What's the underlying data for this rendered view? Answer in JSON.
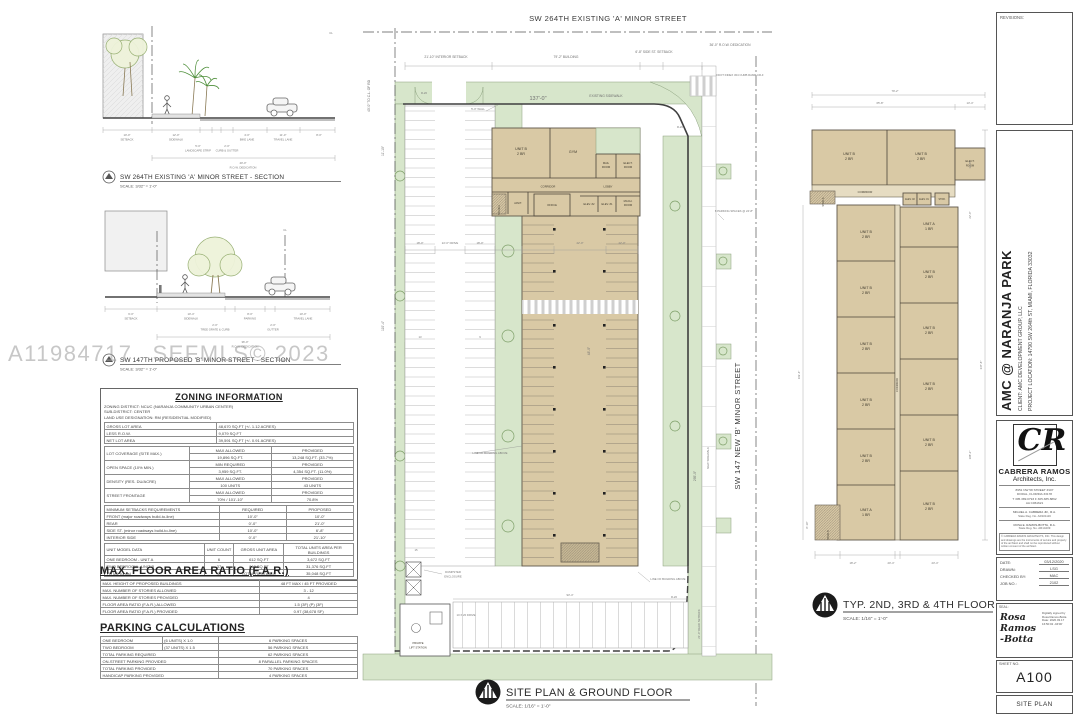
{
  "watermark": {
    "id": "A11984717",
    "mls": "SEFMLS© 2023"
  },
  "section_a": {
    "title": "SW 264TH EXISTING 'A' MINOR STREET - SECTION",
    "scale": "SCALE:  3/32\" = 1'-0\"",
    "dims": [
      {
        "v": "10'-0\"",
        "l": "SETBACK"
      },
      {
        "v": "12'-0\"",
        "l": "SIDEWALK"
      },
      {
        "v": "5'-0\"",
        "l": "LANDSCAPE STRIP"
      },
      {
        "v": "2'-0\"",
        "l": "CURB & GUTTER"
      },
      {
        "v": "4'-0\"",
        "l": "BIKE LANE"
      },
      {
        "v": "11'-0\"",
        "l": "TRAVEL LANE"
      },
      {
        "v": "8'-0\"",
        "l": ""
      }
    ],
    "row": {
      "v": "40'-0\"",
      "l": "R.O.W. DEDICATION"
    },
    "cl": "CL"
  },
  "section_b": {
    "title": "SW 147TH PROPOSED 'B' MINOR STREET - SECTION",
    "scale": "SCALE:  3/32\" = 1'-0\"",
    "dims": [
      {
        "v": "6'-0\"",
        "l": "SETBACK"
      },
      {
        "v": "10'-4\"",
        "l": "SIDEWALK"
      },
      {
        "v": "2'-0\"",
        "l": "TREE GRATE & CURB"
      },
      {
        "v": "8'-0\"",
        "l": "PARKING"
      },
      {
        "v": "2'-0\"",
        "l": "GUTTER"
      },
      {
        "v": "10'-0\"",
        "l": "TRAVEL LANE"
      }
    ],
    "row": {
      "v": "36'-0\"",
      "l": "R.O.W. DEDICATION"
    },
    "cl": "CL"
  },
  "zoning": {
    "title": "ZONING INFORMATION",
    "district": "ZONING DISTRICT: NCUC (NARANJA COMMUNITY URBAN CENTER)",
    "sub": "SUB-DISTRICT: CENTER",
    "landuse": "LAND USE DESIGNATION: RM (RESIDENTIAL MODIFIED)",
    "areas": [
      {
        "label": "GROSS LOT AREA",
        "value": "48,670 SQ.FT (+/- 1.12 ACRES)"
      },
      {
        "label": "LESS R.O.W.",
        "value": "9,079 SQ.FT"
      },
      {
        "label": "NET LOT AREA",
        "value": "39,591 SQ.FT (+/- 0.91 ACRES)"
      }
    ],
    "matrix": [
      {
        "label": "LOT COVERAGE (SITE MAX.)",
        "h1": "MAX ALLOWED",
        "h2": "PROVIDED",
        "v1": "19,896 SQ.FT.",
        "v2": "13,248 SQ.FT. (33.7%)"
      },
      {
        "label": "OPEN SPACE (10% MIN.)",
        "h1": "MIN REQUIRED",
        "h2": "PROVIDED",
        "v1": "3,959 SQ.FT.",
        "v2": "4,354 SQ.FT. (11.0%)"
      },
      {
        "label": "DENSITY (RES. DU/ACRE)",
        "h1": "MAX ALLOWED",
        "h2": "PROVIDED",
        "v1": "100 UNITS",
        "v2": "43 UNITS"
      },
      {
        "label": "STREET FRONTAGE",
        "h1": "MAX ALLOWED",
        "h2": "PROVIDED",
        "v1": "70% / 101'-10\"",
        "v2": "70.8%"
      }
    ],
    "setbacks": {
      "title": "MINIMUM SETBACKS REQUIREMENTS",
      "h1": "REQUIRED",
      "h2": "PROPOSED",
      "rows": [
        {
          "label": "FRONT (major roadways build-to-line)",
          "r": "10'-0\"",
          "p": "10'-0\""
        },
        {
          "label": "REAR",
          "r": "0'-0\"",
          "p": "21'-0\""
        },
        {
          "label": "SIDE ST. (minor roadways build-to-line)",
          "r": "10'-0\"",
          "p": "6'-8\""
        },
        {
          "label": "INTERIOR SIDE",
          "r": "0'-0\"",
          "p": "21'-10\""
        }
      ]
    },
    "units": {
      "h0": "UNIT MODEL DATA",
      "h1": "UNIT COUNT",
      "h2": "GROSS UNIT AREA",
      "h3": "TOTAL UNITS AREA PER BUILDINGS",
      "rows": [
        {
          "label": "ONE BEDROOM  -  UNIT A",
          "c": "6",
          "a": "612 SQ.FT",
          "t": "3,672 SQ.FT"
        },
        {
          "label": "TWO BEDROOM  -  UNIT B",
          "c": "37",
          "a": "848 SQ.FT",
          "t": "31,376 SQ.FT"
        }
      ],
      "trow": {
        "label": "TOTAL (units)",
        "c": "43",
        "a": "TOTAL RENTABLE",
        "t": "35,048 SQ.FT"
      }
    }
  },
  "far": {
    "title": "MAX. FLOOR AREA RATIO (F.A.R.)",
    "rows": [
      {
        "label": "MAX. HEIGHT OF PROPOSED BUILDINGS",
        "value": "48 FT MAX / 45 FT PROVIDED"
      },
      {
        "label": "MAX. NUMBER OF STORIES ALLOWED",
        "value": "3 - 12"
      },
      {
        "label": "MAX. NUMBER OF STORIES PROVIDED",
        "value": "4"
      },
      {
        "label": "FLOOR AREA RATIO (F.A.R.) ALLOWED",
        "value": "1.5 (3F) (P) (3F)"
      },
      {
        "label": "FLOOR AREA RATIO (F.A.R.) PROVIDED",
        "value": "0.97 (38,678 SF)"
      }
    ]
  },
  "parking_calc": {
    "title": "PARKING CALCULATIONS",
    "rows": [
      {
        "label": "ONE BEDROOM",
        "calc": "(6 UNITS) X 1.0",
        "value": "6 PARKING SPACES"
      },
      {
        "label": "TWO BEDROOM",
        "calc": "(37 UNITS) X 1.5",
        "value": "56 PARKING SPACES"
      }
    ],
    "totals": [
      {
        "label": "TOTAL PARKING REQUIRED",
        "value": "62 PARKING SPACES"
      },
      {
        "label": "ON-STREET PARKING PROVIDED",
        "value": "8 PARALLEL PARKING SPACES"
      },
      {
        "label": "TOTAL PARKING PROVIDED",
        "value": "70 PARKING SPACES"
      },
      {
        "label": "HANDICAP PARKING PROVIDED",
        "value": "4 PARKING SPACES"
      }
    ]
  },
  "site": {
    "street_top": "SW 264TH EXISTING 'A' MINOR STREET",
    "street_right": "SW 147 NEW 'B' MINOR STREET",
    "title": "SITE PLAN & GROUND FLOOR",
    "scale": "SCALE:   1/16\" = 1'-0\"",
    "dims": {
      "interior_setback": "21'-10\" INTERIOR SETBACK",
      "building": "79'-2\"  BUILDING",
      "side_setback": "6'-8\" SIDE ST. SETBACK",
      "row_ded": "36'-0\" R.O.W. DEDICATION",
      "d137": "137'-0\"",
      "d295": "295'-0\"",
      "d110": "110'-4\"",
      "d1110": "11'-10\"",
      "d48": "48'-0\"",
      "d18a": "18'-0\"",
      "drive": "22'-0\" DRIVE",
      "d18b": "18'-0\"",
      "d22a": "22'-0\"",
      "d22b": "22'-0\"",
      "d934": "93'-4\"",
      "rear": "21'-0\" REAR SETBACK",
      "to_cl": "40'-0\" TO C.L. OF RD"
    },
    "notes": {
      "existing_sidewalk": "EXISTING SIDEWALK",
      "new_sidewalk": "NEW SIDEWALK",
      "wall": "5'-0\" WALL",
      "fdot": "FDOT INDEX 304 CURB RAMP CR-F",
      "parking8": "8 PARKING SPACES @ 24'-8\"",
      "dumpster1": "DUMPSTER",
      "dumpster2": "ENCLOSURE",
      "lift1": "PRIVATE",
      "lift2": "LIFT STATION",
      "drive1020": "10 X 20 DRIVE",
      "line_above1": "LINE OF BUILDING ABOVE",
      "line_above2": "LINE OF BUILDING ABOVE",
      "r20": "R-20",
      "s13": "13",
      "s9": "9",
      "s15": "15"
    },
    "rooms": {
      "unit_b": "UNIT B",
      "br2": "2 BR",
      "gym": "GYM",
      "mail1": "MAIL",
      "mail2": "ROOM",
      "elect1": "ELECT.",
      "elect2": "ROOM",
      "corridor": "CORRIDOR",
      "lobby": "LOBBY",
      "stair_a": "STAIR A",
      "janit": "JANIT.",
      "office": "OFFICE",
      "elev2": "ELEV. #2",
      "elev1": "ELEV. #1",
      "mach1": "MACH.",
      "mach2": "ROOM"
    }
  },
  "floor": {
    "title": "TYP. 2ND, 3RD & 4TH FLOOR",
    "scale": "SCALE:   1/16\" = 1'-0\"",
    "rooms": {
      "unit_b": "UNIT B",
      "br2": "2 BR",
      "unit_a": "UNIT A",
      "br1": "1 BR",
      "elect1": "ELECT.",
      "elect2": "ROOM",
      "corridor": "CORRIDOR",
      "stair_a": "STAIR A",
      "stair_b": "STAIR B",
      "elev2": "ELEV. #2",
      "elev1": "ELEV. #1",
      "stor": "STOR."
    },
    "dims": {
      "w": "79'-2\"",
      "w1": "65'-8\"",
      "w2": "13'-4\"",
      "r1": "13'-8\"",
      "r2": "22'-0\"",
      "h": "337'-8\"",
      "h2": "188'-2\"",
      "l": "119'-4\"",
      "s": "8'-10\"",
      "b1": "18'-2\"",
      "b2": "20'-4\"",
      "b3": "23'-4\""
    }
  },
  "tb": {
    "revisions": "REVISIONS:",
    "project": "AMC @ NARANJA PARK",
    "client": "CLIENT: AMC DEVELOPMENT GROUP, LLC",
    "location": "PROJECT LOCATION: 14790 SW 264th ST, MIAMI, FLORIDA 33032",
    "logo": "CR",
    "firm1": "CABRERA RAMOS",
    "firm2": "Architects, Inc.",
    "addr1": "8951 NW 58 STREET  #107",
    "addr2": "DORAL, FLORIDA 33178",
    "addr3": "T 305.389.0793  F 305.385.8862",
    "addr4": "AA C061621",
    "reg1": "MIGUEL A. CABRERA JR., R.A.",
    "reg1b": "State Reg. No. AR101116",
    "reg2": "ROSA E. RAMOS-BOTTA, R.A.",
    "reg2b": "State Reg. No. AR14209",
    "note": "© CABRERA RAMOS ARCHITECTS, INC. This design and drawings are the instruments of service and property of the architect and shall not be reproduced without written consent of the architect.",
    "date_l": "DATE:",
    "date": "03/12/2020",
    "drawn_l": "DRAWN:",
    "drawn": "LSG",
    "check_l": "CHECKED BY:",
    "check": "MAC",
    "job_l": "JOB NO.:",
    "job": "2102",
    "seal_l": "SEAL:",
    "sig": "Rosa Ramos -Botta",
    "sig_note": "Digitally signed by Rosa Ramos-Botta Date: 2020.03.17 16:50:02 -04'00'",
    "sheet_l": "SHEET NO.",
    "sheet": "A100",
    "sheet_name": "SITE PLAN"
  }
}
